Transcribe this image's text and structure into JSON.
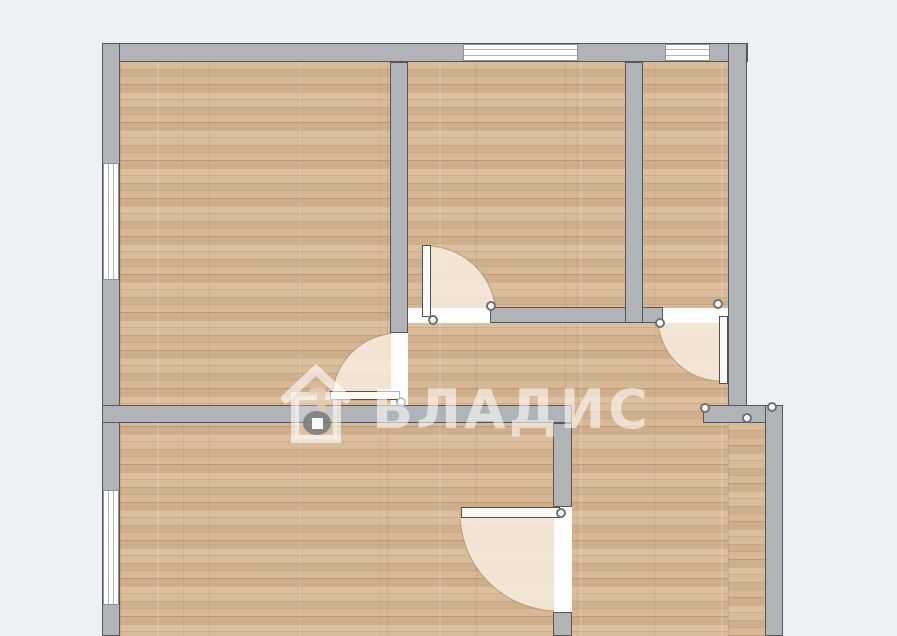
{
  "watermark": {
    "text": "ВЛАДИС",
    "house_number": "1"
  },
  "colors": {
    "background": "#edf0f5",
    "wall_fill": "#b0b3b8",
    "wall_outline": "#54565a",
    "floor_base": "#d6b593",
    "door_arc_fill": "rgba(246,236,222,0.88)",
    "window_fill": "#ffffff",
    "watermark_color": "rgba(255,255,255,0.58)"
  },
  "plan": {
    "floors": [
      {
        "name": "floor-main",
        "x": 120,
        "y": 62,
        "w": 608,
        "h": 574
      },
      {
        "name": "floor-bottom-right-extension",
        "x": 728,
        "y": 423,
        "w": 39,
        "h": 213
      }
    ],
    "walls": [
      {
        "name": "wall-top",
        "x": 102,
        "y": 43,
        "w": 646,
        "h": 19
      },
      {
        "name": "wall-left",
        "x": 102,
        "y": 43,
        "w": 18,
        "h": 593
      },
      {
        "name": "wall-right-upper",
        "x": 728,
        "y": 43,
        "w": 19,
        "h": 364
      },
      {
        "name": "wall-step-right",
        "x": 703,
        "y": 405,
        "w": 80,
        "h": 18
      },
      {
        "name": "wall-right-lower",
        "x": 765,
        "y": 405,
        "w": 18,
        "h": 231
      },
      {
        "name": "wall-topleft-room-right",
        "x": 390,
        "y": 62,
        "w": 18,
        "h": 271
      },
      {
        "name": "wall-middle-horizontal",
        "x": 102,
        "y": 405,
        "w": 470,
        "h": 18
      },
      {
        "name": "wall-midroom-bottom",
        "x": 490,
        "y": 307,
        "w": 173,
        "h": 16
      },
      {
        "name": "wall-midright-vertical",
        "x": 625,
        "y": 62,
        "w": 18,
        "h": 261
      },
      {
        "name": "wall-bottomrooms-divider-upper",
        "x": 553,
        "y": 423,
        "w": 19,
        "h": 84
      },
      {
        "name": "wall-bottomrooms-divider-lower",
        "x": 553,
        "y": 612,
        "w": 19,
        "h": 24
      }
    ],
    "openings": [
      {
        "x": 408,
        "y": 308,
        "w": 82,
        "h": 15
      },
      {
        "x": 391,
        "y": 333,
        "w": 17,
        "h": 72
      },
      {
        "x": 663,
        "y": 308,
        "w": 65,
        "h": 15
      },
      {
        "x": 554,
        "y": 507,
        "w": 18,
        "h": 105
      }
    ],
    "windows": [
      {
        "x": 463,
        "y": 44,
        "w": 115,
        "h": 17,
        "o": "h"
      },
      {
        "x": 665,
        "y": 44,
        "w": 45,
        "h": 17,
        "o": "h"
      },
      {
        "x": 103,
        "y": 163,
        "w": 16,
        "h": 117,
        "o": "v"
      },
      {
        "x": 103,
        "y": 490,
        "w": 16,
        "h": 115,
        "o": "v"
      }
    ],
    "arcs": [
      {
        "name": "door-arc-midroom",
        "cx": 426,
        "cy": 316,
        "r": 70,
        "a": "up",
        "b": "right",
        "sweep": 1
      },
      {
        "name": "door-arc-topleft-room",
        "cx": 399,
        "cy": 400,
        "r": 67,
        "a": "up",
        "b": "left",
        "sweep": 0
      },
      {
        "name": "door-arc-topright-room",
        "cx": 721,
        "cy": 318,
        "r": 63,
        "a": "left",
        "b": "down",
        "sweep": 0
      },
      {
        "name": "door-arc-bottom-rooms",
        "cx": 558,
        "cy": 513,
        "r": 98,
        "a": "left",
        "b": "down",
        "sweep": 0
      }
    ],
    "leaves": [
      {
        "x": 422,
        "y": 245,
        "w": 9,
        "h": 72
      },
      {
        "x": 330,
        "y": 391,
        "w": 70,
        "h": 9
      },
      {
        "x": 719,
        "y": 316,
        "w": 9,
        "h": 68
      },
      {
        "x": 461,
        "y": 507,
        "w": 99,
        "h": 11
      }
    ],
    "markers": [
      {
        "x": 433,
        "y": 320
      },
      {
        "x": 491,
        "y": 306
      },
      {
        "x": 401,
        "y": 402
      },
      {
        "x": 718,
        "y": 304
      },
      {
        "x": 660,
        "y": 323
      },
      {
        "x": 561,
        "y": 513
      },
      {
        "x": 705,
        "y": 408
      },
      {
        "x": 747,
        "y": 418
      },
      {
        "x": 772,
        "y": 407
      }
    ]
  }
}
